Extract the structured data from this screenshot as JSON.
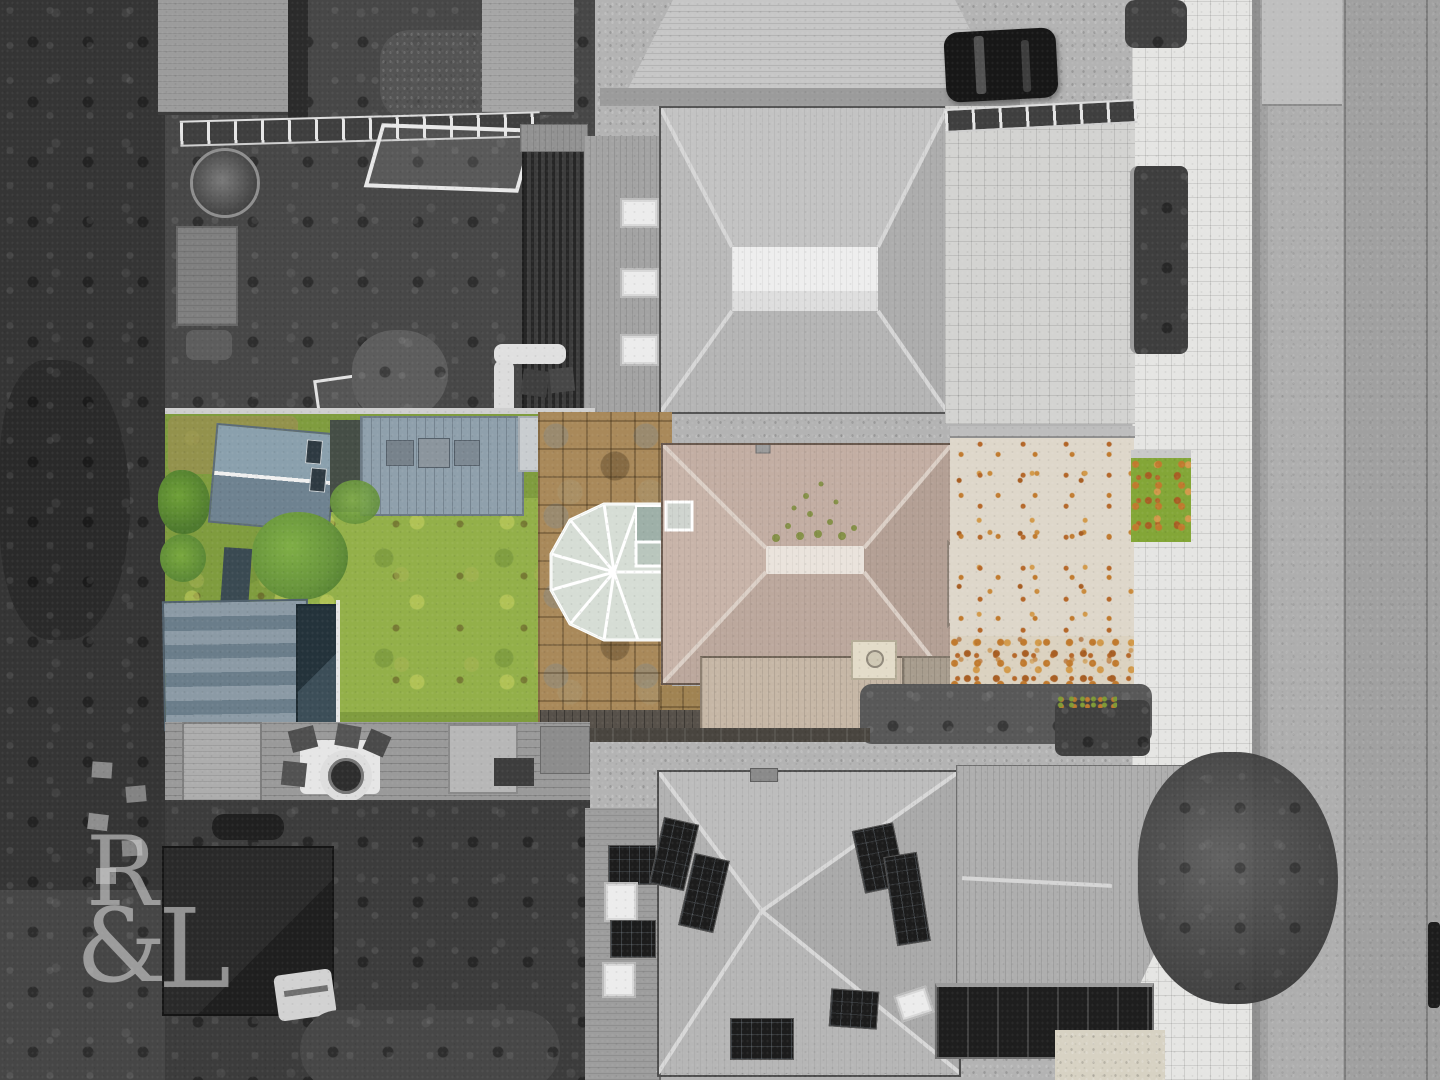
{
  "meta": {
    "kind": "aerial-drone-photograph",
    "treatment": "selective-color: subject property shown in colour, all surroundings in monochrome",
    "view": "top-down (nadir) view of a residential street"
  },
  "watermark": {
    "r": "R",
    "amp": "&",
    "l": "L",
    "color": "#e9e9e9",
    "position": "bottom-left"
  },
  "colors": {
    "subject_roof": "#c1aba0",
    "subject_ridge": "#eae3dc",
    "lawn_green": "#8fae46",
    "tree_green": "#68953c",
    "patio_stone": "#a9895a",
    "conservatory_glass": "#d6ddd5",
    "conservatory_frame": "#ffffff",
    "shed_roof_blue": "#8296a4",
    "outbuilding_roof": "#6a7d8a",
    "front_gravel": "#ded7ca",
    "leaf_orange": "#c07a2e",
    "grass_patch": "#83a637",
    "mono_road": "#a2a2a2",
    "mono_footpath": "#e5e5e3",
    "mono_roof": "#b8b8b8",
    "mono_woodland": "#353535",
    "solar_panel": "#1c1c1c",
    "car_black": "#171717"
  },
  "scene": {
    "subject_property": {
      "label": "colour-highlighted detached bungalow plot",
      "features": [
        "hipped brown tiled roof",
        "white conservatory with glass roof",
        "rear lawn",
        "stone patio",
        "blue-grey garden shed",
        "striped outbuilding roof",
        "decked area with furniture",
        "front gravel drive covered in autumn leaves",
        "small green grass patch",
        "cream chimney stack"
      ]
    },
    "surroundings": {
      "label": "monochrome neighbourhood",
      "features": [
        "neighbouring hipped roofs",
        "flat white roof section",
        "solar panel arrays",
        "black parked car",
        "white football goals",
        "trampoline",
        "corrugated garage roof",
        "fire-pit seating circle",
        "street tree over footpath",
        "block-paved footpath",
        "asphalt road",
        "dark woodland strip"
      ]
    }
  }
}
